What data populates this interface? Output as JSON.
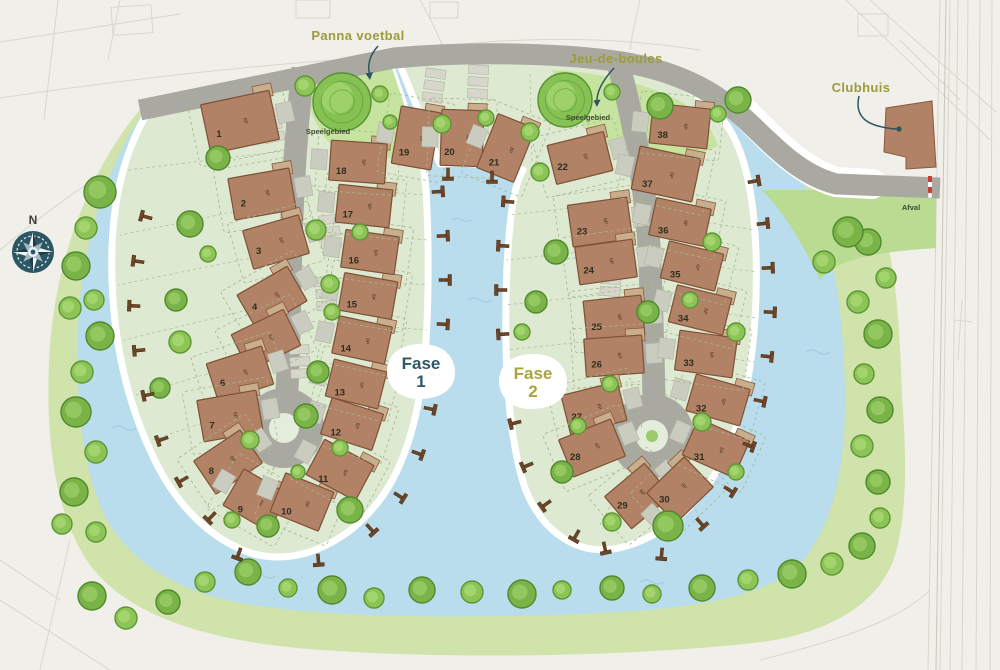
{
  "compass": {
    "label": "N"
  },
  "phase_badges": {
    "fase1": {
      "label": "Fase",
      "num": "1",
      "color": "#2d5a66"
    },
    "fase2": {
      "label": "Fase",
      "num": "2",
      "color": "#a8a43e"
    }
  },
  "labels": {
    "panna_voetbal": {
      "text": "Panna voetbal"
    },
    "jeu_de_boules": {
      "text": "Jeu-de-boules"
    },
    "clubhuis": {
      "text": "Clubhuis"
    },
    "speelgebied_west": {
      "text": "Speelgebied"
    },
    "speelgebied_east": {
      "text": "Speelgebied"
    },
    "afval": {
      "text": "Afval"
    }
  },
  "houses": [
    {
      "n": "1",
      "x": 240,
      "y": 122,
      "w": 70,
      "h": 50,
      "rot": -12,
      "side": 1,
      "cap": "6P"
    },
    {
      "n": "2",
      "x": 262,
      "y": 194,
      "w": 62,
      "h": 42,
      "rot": -10,
      "side": 1,
      "cap": "6P"
    },
    {
      "n": "3",
      "x": 276,
      "y": 242,
      "w": 58,
      "h": 40,
      "rot": -16,
      "side": 1,
      "cap": "6P"
    },
    {
      "n": "4",
      "x": 272,
      "y": 298,
      "w": 58,
      "h": 40,
      "rot": -30,
      "side": 1,
      "cap": "6P"
    },
    {
      "n": "5",
      "x": 266,
      "y": 340,
      "w": 58,
      "h": 40,
      "rot": -26,
      "side": 1,
      "cap": "6P"
    },
    {
      "n": "6",
      "x": 240,
      "y": 374,
      "w": 58,
      "h": 40,
      "rot": -18,
      "side": 1,
      "cap": "6P"
    },
    {
      "n": "7",
      "x": 230,
      "y": 416,
      "w": 60,
      "h": 42,
      "rot": -10,
      "side": 1,
      "cap": "6P"
    },
    {
      "n": "8",
      "x": 228,
      "y": 462,
      "w": 56,
      "h": 40,
      "rot": -34,
      "side": 1,
      "cap": "6P"
    },
    {
      "n": "9",
      "x": 256,
      "y": 500,
      "w": 52,
      "h": 42,
      "rot": 30,
      "side": -1,
      "cap": "6P"
    },
    {
      "n": "10",
      "x": 302,
      "y": 502,
      "w": 52,
      "h": 42,
      "rot": 22,
      "side": -1,
      "cap": "6P"
    },
    {
      "n": "11",
      "x": 340,
      "y": 470,
      "w": 56,
      "h": 40,
      "rot": 28,
      "side": -1,
      "cap": "6P"
    },
    {
      "n": "12",
      "x": 352,
      "y": 424,
      "w": 54,
      "h": 38,
      "rot": 18,
      "side": -1,
      "cap": "6P"
    },
    {
      "n": "13",
      "x": 356,
      "y": 384,
      "w": 54,
      "h": 38,
      "rot": 14,
      "side": -1,
      "cap": "6P"
    },
    {
      "n": "14",
      "x": 362,
      "y": 340,
      "w": 54,
      "h": 38,
      "rot": 12,
      "side": -1,
      "cap": "6P"
    },
    {
      "n": "15",
      "x": 368,
      "y": 296,
      "w": 54,
      "h": 38,
      "rot": 10,
      "side": -1,
      "cap": "6P"
    },
    {
      "n": "16",
      "x": 370,
      "y": 252,
      "w": 54,
      "h": 38,
      "rot": 8,
      "side": -1,
      "cap": "6P"
    },
    {
      "n": "17",
      "x": 364,
      "y": 206,
      "w": 54,
      "h": 38,
      "rot": 6,
      "side": -1,
      "cap": "6P"
    },
    {
      "n": "18",
      "x": 358,
      "y": 162,
      "w": 56,
      "h": 40,
      "rot": 4,
      "side": -1,
      "cap": "6P"
    },
    {
      "n": "19",
      "x": 416,
      "y": 138,
      "w": 40,
      "h": 58,
      "rot": 10,
      "side": -1,
      "cap": "8P"
    },
    {
      "n": "20",
      "x": 462,
      "y": 138,
      "w": 42,
      "h": 56,
      "rot": 2,
      "side": -1,
      "cap": "4P"
    },
    {
      "n": "21",
      "x": 506,
      "y": 148,
      "w": 40,
      "h": 58,
      "rot": 22,
      "side": -1,
      "cap": "8P"
    },
    {
      "n": "22",
      "x": 580,
      "y": 158,
      "w": 58,
      "h": 40,
      "rot": -14,
      "side": 1,
      "cap": "6P"
    },
    {
      "n": "23",
      "x": 600,
      "y": 222,
      "w": 60,
      "h": 42,
      "rot": -8,
      "side": 1,
      "cap": "6P"
    },
    {
      "n": "24",
      "x": 606,
      "y": 262,
      "w": 58,
      "h": 38,
      "rot": -8,
      "side": 1,
      "cap": "6P"
    },
    {
      "n": "25",
      "x": 614,
      "y": 318,
      "w": 58,
      "h": 40,
      "rot": -6,
      "side": 1,
      "cap": "6P"
    },
    {
      "n": "26",
      "x": 614,
      "y": 356,
      "w": 58,
      "h": 38,
      "rot": -4,
      "side": 1,
      "cap": "6P"
    },
    {
      "n": "27",
      "x": 594,
      "y": 408,
      "w": 58,
      "h": 40,
      "rot": -14,
      "side": 1,
      "cap": "6P"
    },
    {
      "n": "28",
      "x": 592,
      "y": 448,
      "w": 56,
      "h": 40,
      "rot": -22,
      "side": 1,
      "cap": "6P"
    },
    {
      "n": "29",
      "x": 638,
      "y": 496,
      "w": 52,
      "h": 42,
      "rot": -40,
      "side": 1,
      "cap": "6P"
    },
    {
      "n": "30",
      "x": 680,
      "y": 490,
      "w": 52,
      "h": 42,
      "rot": -44,
      "side": -1,
      "cap": "6P"
    },
    {
      "n": "31",
      "x": 716,
      "y": 448,
      "w": 56,
      "h": 40,
      "rot": 24,
      "side": -1,
      "cap": "6P"
    },
    {
      "n": "32",
      "x": 718,
      "y": 400,
      "w": 56,
      "h": 38,
      "rot": 16,
      "side": -1,
      "cap": "6P"
    },
    {
      "n": "33",
      "x": 706,
      "y": 354,
      "w": 58,
      "h": 40,
      "rot": 8,
      "side": -1,
      "cap": "6P"
    },
    {
      "n": "34",
      "x": 700,
      "y": 310,
      "w": 56,
      "h": 38,
      "rot": 14,
      "side": -1,
      "cap": "6P"
    },
    {
      "n": "35",
      "x": 692,
      "y": 266,
      "w": 56,
      "h": 38,
      "rot": 14,
      "side": -1,
      "cap": "6P"
    },
    {
      "n": "36",
      "x": 680,
      "y": 222,
      "w": 56,
      "h": 38,
      "rot": 12,
      "side": -1,
      "cap": "6P"
    },
    {
      "n": "37",
      "x": 666,
      "y": 174,
      "w": 62,
      "h": 44,
      "rot": 12,
      "side": -1,
      "cap": "6P"
    },
    {
      "n": "38",
      "x": 680,
      "y": 126,
      "w": 58,
      "h": 40,
      "rot": 6,
      "side": -1,
      "cap": "6P"
    }
  ],
  "trees": [
    [
      100,
      192,
      16,
      1
    ],
    [
      86,
      228,
      11,
      0
    ],
    [
      76,
      266,
      14,
      1
    ],
    [
      94,
      300,
      10,
      0
    ],
    [
      70,
      308,
      11,
      0
    ],
    [
      100,
      336,
      14,
      1
    ],
    [
      82,
      372,
      11,
      0
    ],
    [
      76,
      412,
      15,
      1
    ],
    [
      96,
      452,
      11,
      0
    ],
    [
      74,
      492,
      14,
      1
    ],
    [
      62,
      524,
      10,
      0
    ],
    [
      96,
      532,
      10,
      0
    ],
    [
      92,
      596,
      14,
      1
    ],
    [
      126,
      618,
      11,
      0
    ],
    [
      168,
      602,
      12,
      1
    ],
    [
      205,
      582,
      10,
      0
    ],
    [
      248,
      572,
      13,
      1
    ],
    [
      288,
      588,
      9,
      0
    ],
    [
      332,
      590,
      14,
      1
    ],
    [
      374,
      598,
      10,
      0
    ],
    [
      422,
      590,
      13,
      1
    ],
    [
      472,
      592,
      11,
      0
    ],
    [
      522,
      594,
      14,
      1
    ],
    [
      562,
      590,
      9,
      0
    ],
    [
      612,
      588,
      12,
      1
    ],
    [
      652,
      594,
      9,
      0
    ],
    [
      702,
      588,
      13,
      1
    ],
    [
      748,
      580,
      10,
      0
    ],
    [
      792,
      574,
      14,
      1
    ],
    [
      832,
      564,
      11,
      0
    ],
    [
      862,
      546,
      13,
      1
    ],
    [
      880,
      518,
      10,
      0
    ],
    [
      868,
      242,
      13,
      1
    ],
    [
      886,
      278,
      10,
      0
    ],
    [
      858,
      302,
      11,
      0
    ],
    [
      878,
      334,
      14,
      1
    ],
    [
      864,
      374,
      10,
      0
    ],
    [
      880,
      410,
      13,
      1
    ],
    [
      862,
      446,
      11,
      0
    ],
    [
      878,
      482,
      12,
      1
    ],
    [
      848,
      232,
      15,
      1
    ],
    [
      824,
      262,
      11,
      0
    ],
    [
      738,
      100,
      13,
      1
    ],
    [
      342,
      102,
      29,
      2
    ],
    [
      305,
      86,
      10,
      0
    ],
    [
      380,
      94,
      8,
      0
    ],
    [
      390,
      122,
      7,
      0
    ],
    [
      218,
      158,
      12,
      1
    ],
    [
      190,
      224,
      13,
      1
    ],
    [
      208,
      254,
      8,
      0
    ],
    [
      316,
      230,
      10,
      0
    ],
    [
      360,
      232,
      8,
      0
    ],
    [
      176,
      300,
      11,
      1
    ],
    [
      330,
      284,
      9,
      0
    ],
    [
      332,
      312,
      8,
      0
    ],
    [
      180,
      342,
      11,
      0
    ],
    [
      160,
      388,
      10,
      1
    ],
    [
      250,
      440,
      9,
      0
    ],
    [
      318,
      372,
      11,
      1
    ],
    [
      306,
      416,
      12,
      1
    ],
    [
      340,
      448,
      8,
      0
    ],
    [
      268,
      526,
      11,
      1
    ],
    [
      232,
      520,
      8,
      0
    ],
    [
      350,
      510,
      13,
      1
    ],
    [
      298,
      472,
      7,
      0
    ],
    [
      442,
      124,
      9,
      0
    ],
    [
      486,
      118,
      8,
      0
    ],
    [
      530,
      132,
      9,
      0
    ],
    [
      565,
      100,
      27,
      2
    ],
    [
      612,
      92,
      8,
      0
    ],
    [
      660,
      106,
      13,
      1
    ],
    [
      718,
      114,
      8,
      0
    ],
    [
      540,
      172,
      9,
      0
    ],
    [
      556,
      252,
      12,
      1
    ],
    [
      712,
      242,
      9,
      0
    ],
    [
      536,
      302,
      11,
      1
    ],
    [
      648,
      312,
      11,
      1
    ],
    [
      610,
      384,
      8,
      0
    ],
    [
      530,
      392,
      10,
      0
    ],
    [
      578,
      426,
      8,
      0
    ],
    [
      690,
      300,
      8,
      0
    ],
    [
      736,
      332,
      9,
      0
    ],
    [
      702,
      422,
      9,
      0
    ],
    [
      562,
      472,
      11,
      1
    ],
    [
      668,
      526,
      15,
      1
    ],
    [
      612,
      522,
      9,
      0
    ],
    [
      736,
      472,
      8,
      0
    ],
    [
      522,
      332,
      8,
      0
    ]
  ],
  "jetties": [
    [
      150,
      218,
      195
    ],
    [
      142,
      262,
      188
    ],
    [
      138,
      306,
      182
    ],
    [
      143,
      350,
      175
    ],
    [
      152,
      394,
      168
    ],
    [
      166,
      438,
      160
    ],
    [
      186,
      478,
      150
    ],
    [
      214,
      514,
      135
    ],
    [
      240,
      550,
      110
    ],
    [
      318,
      556,
      85
    ],
    [
      434,
      192,
      -4
    ],
    [
      439,
      236,
      -2
    ],
    [
      441,
      280,
      0
    ],
    [
      439,
      324,
      3
    ],
    [
      433,
      368,
      7
    ],
    [
      426,
      408,
      12
    ],
    [
      414,
      452,
      20
    ],
    [
      396,
      494,
      32
    ],
    [
      368,
      526,
      48
    ],
    [
      512,
      202,
      184
    ],
    [
      507,
      246,
      182
    ],
    [
      505,
      290,
      180
    ],
    [
      507,
      334,
      177
    ],
    [
      511,
      378,
      173
    ],
    [
      519,
      422,
      166
    ],
    [
      531,
      464,
      157
    ],
    [
      549,
      502,
      144
    ],
    [
      578,
      532,
      120
    ],
    [
      750,
      182,
      -10
    ],
    [
      759,
      224,
      -6
    ],
    [
      764,
      268,
      -2
    ],
    [
      766,
      312,
      2
    ],
    [
      763,
      356,
      6
    ],
    [
      756,
      400,
      12
    ],
    [
      745,
      444,
      20
    ],
    [
      726,
      488,
      32
    ],
    [
      698,
      520,
      48
    ],
    [
      604,
      544,
      78
    ],
    [
      662,
      550,
      95
    ],
    [
      448,
      170,
      90
    ],
    [
      492,
      173,
      90
    ]
  ],
  "strips": [
    [
      272,
      126,
      -12
    ],
    [
      330,
      232,
      -6
    ],
    [
      326,
      294,
      -4
    ],
    [
      300,
      362,
      -4
    ],
    [
      434,
      86,
      8
    ],
    [
      478,
      82,
      3
    ],
    [
      606,
      230,
      6
    ],
    [
      610,
      292,
      4
    ],
    [
      602,
      354,
      4
    ]
  ]
}
